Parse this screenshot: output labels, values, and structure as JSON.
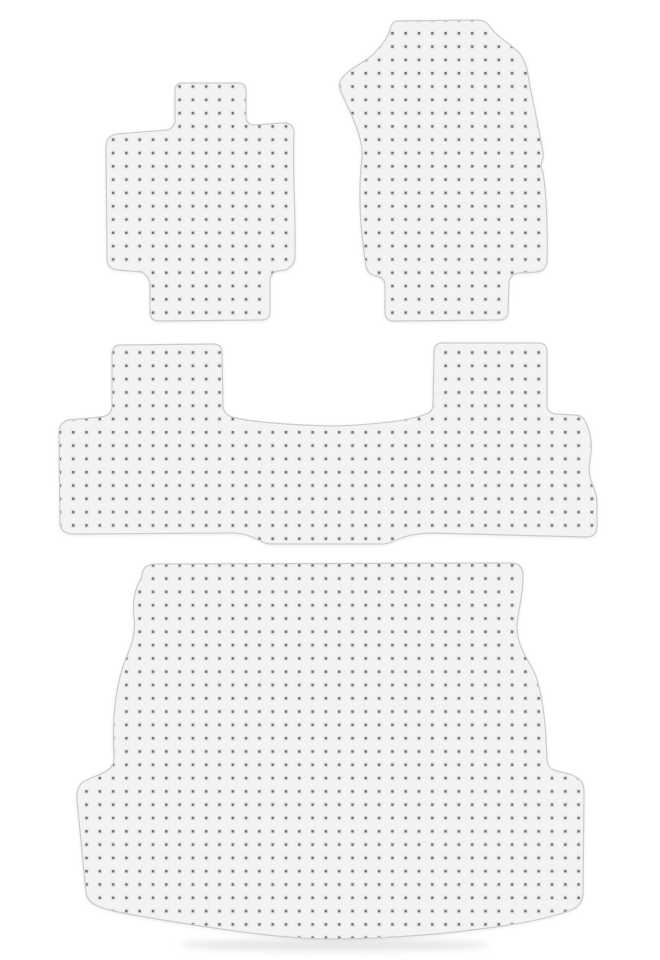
{
  "page": {
    "kind": "product-photo",
    "description": "Four-piece clear vinyl automotive floor mat set with nibbed dot texture on a white background",
    "background_color": "#ffffff"
  },
  "colors": {
    "mat_fill": "#f3f3f4",
    "dot": "#737378",
    "dot_halo": "#e2e2e4",
    "outline": "#c9cdd2",
    "shadow": "#e0e0e3"
  },
  "mats": [
    {
      "id": "front-mat-left",
      "label": "Front floor mat (passenger side) with top tab and bottom heel tab"
    },
    {
      "id": "front-mat-right",
      "label": "Front floor mat (driver side) with pointed left shoulder and bottom tab"
    },
    {
      "id": "rear-bench-mat",
      "label": "Rear bench floor mat with two seat towers, center saddle dip and bottom hump"
    },
    {
      "id": "cargo-mat",
      "label": "Cargo / trunk mat with flared side wings and curved bottom edge"
    }
  ]
}
